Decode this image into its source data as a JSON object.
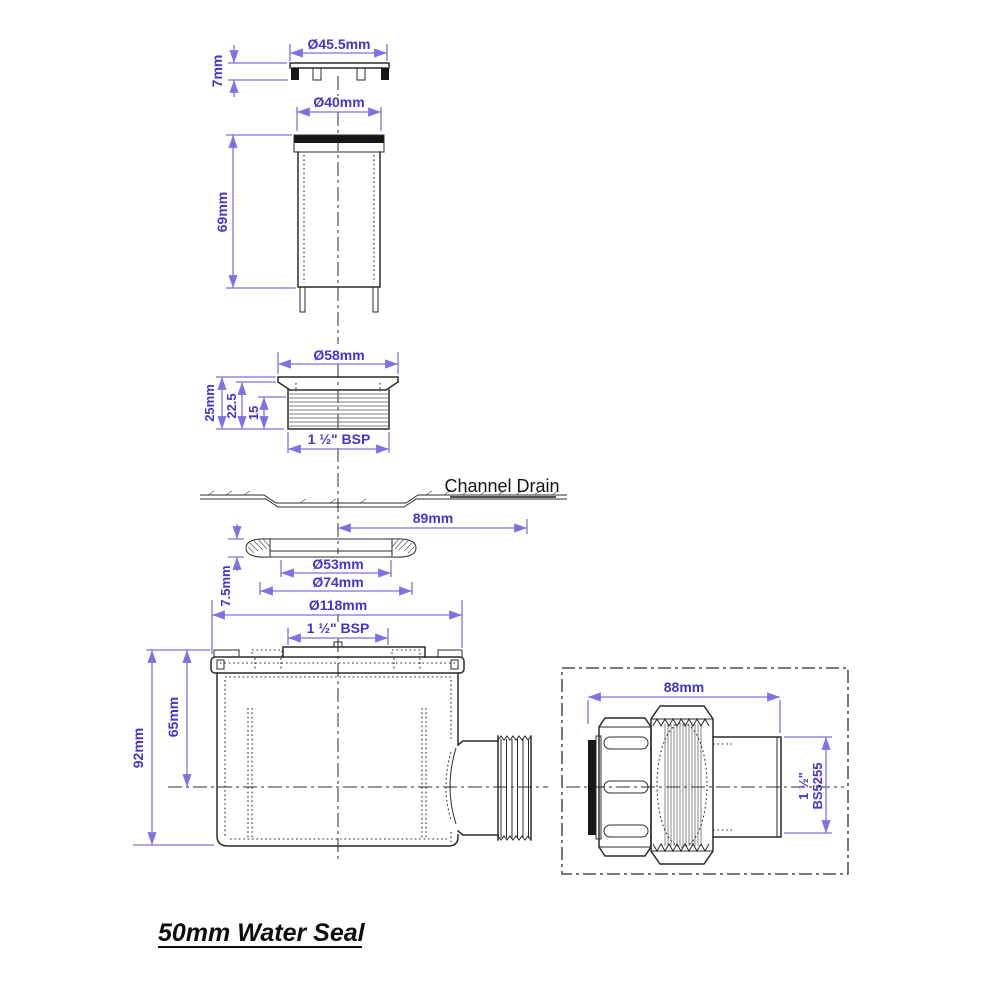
{
  "title": "50mm Water Seal",
  "colors": {
    "dimension_line": "#7e72e2",
    "dimension_text": "#4335cc",
    "drawing_line": "#2b2b2b",
    "background": "#ffffff"
  },
  "grate": {
    "diameter": "Ø45.5mm",
    "height": "7mm"
  },
  "tube": {
    "diameter": "Ø40mm",
    "height": "69mm"
  },
  "adapter": {
    "diameter": "Ø58mm",
    "overall_height": "25mm",
    "height_to_thread": "22.5",
    "thread_length": "15",
    "thread_spec": "1 ½\" BSP"
  },
  "channel_drain": {
    "label": "Channel Drain",
    "centre_offset": "89mm"
  },
  "seal_ring": {
    "inner_diameter": "Ø53mm",
    "outer_diameter": "Ø74mm",
    "height": "7.5mm"
  },
  "trap_body": {
    "flange_diameter": "Ø118mm",
    "thread_spec": "1 ½\" BSP",
    "overall_height": "92mm",
    "depth_to_centre": "65mm"
  },
  "outlet_fitting": {
    "length": "88mm",
    "pipe_size": "1 ½\"",
    "pipe_standard": "BS5255"
  }
}
